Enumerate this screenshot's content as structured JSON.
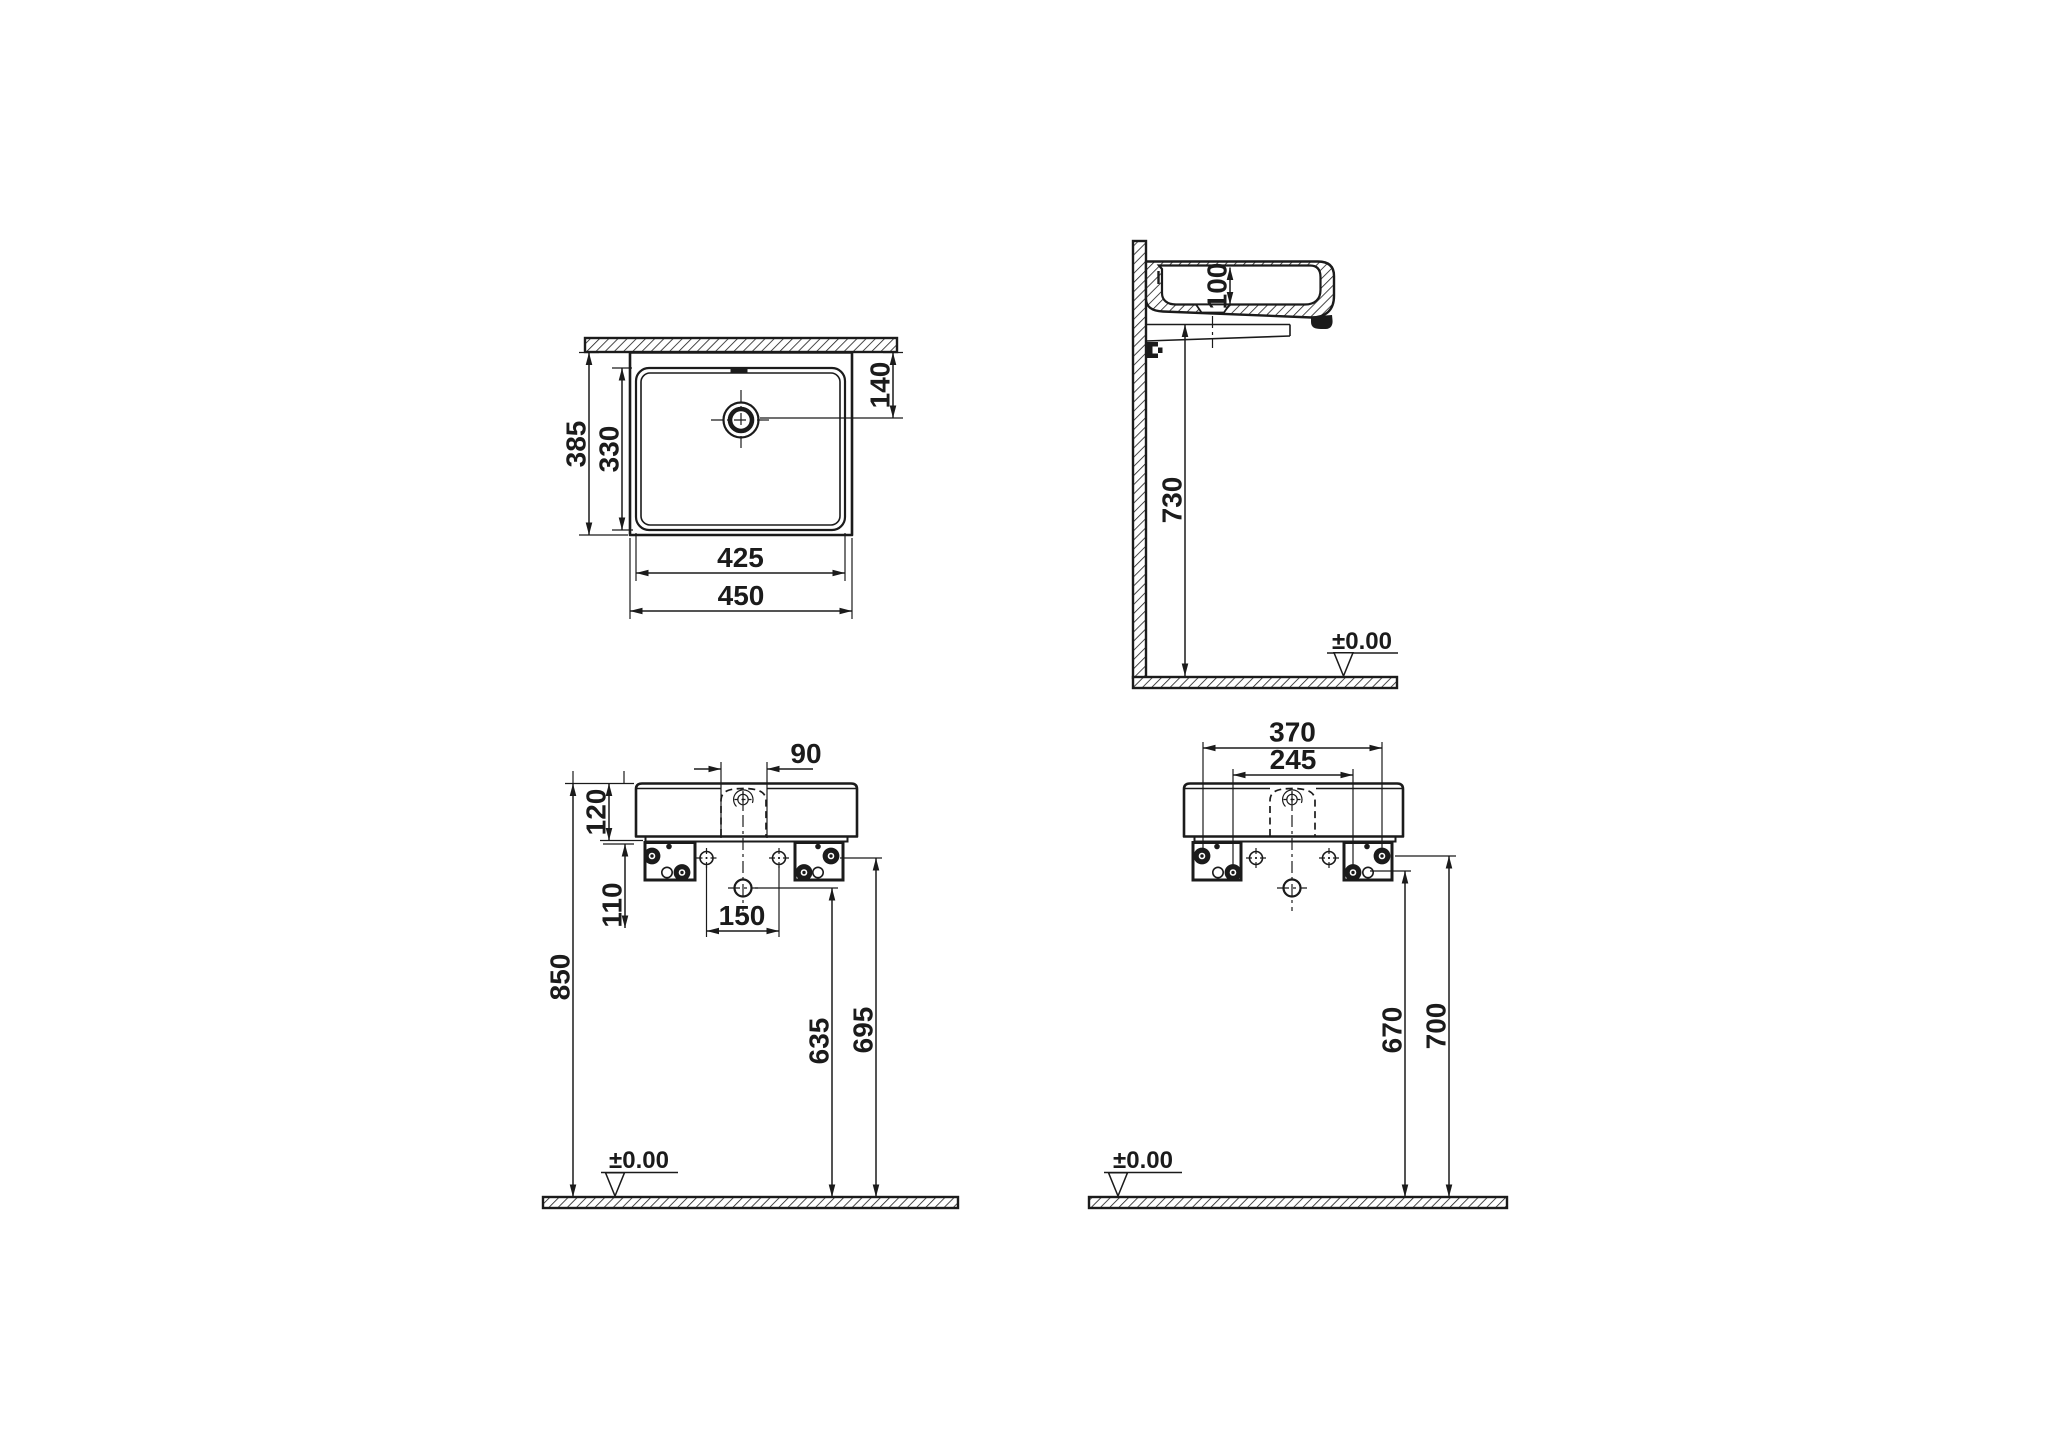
{
  "drawing": {
    "title": "Wall-mounted washbasin installation drawing",
    "datum_label": "±0.00",
    "colors": {
      "ink": "#1b1b1b",
      "paper": "#ffffff"
    },
    "views": {
      "plan": {
        "name": "top-view",
        "dims": {
          "outer_width": "450",
          "inner_width": "425",
          "outer_depth": "385",
          "inner_depth": "330",
          "drain_offset_from_wall": "140"
        }
      },
      "side": {
        "name": "side-section-view",
        "dims": {
          "basin_depth": "100",
          "underside_height": "730"
        }
      },
      "front": {
        "name": "front-view",
        "dims": {
          "overflow_width": "90",
          "body_height": "120",
          "bracket_drop": "110",
          "hole_spacing": "150",
          "rim_height": "850",
          "drain_center_height": "635",
          "bracket_bolt_height": "695"
        }
      },
      "rear": {
        "name": "rear-view",
        "dims": {
          "fixing_span_outer": "370",
          "fixing_span_inner": "245",
          "height_lower": "670",
          "height_upper": "700"
        }
      }
    }
  }
}
